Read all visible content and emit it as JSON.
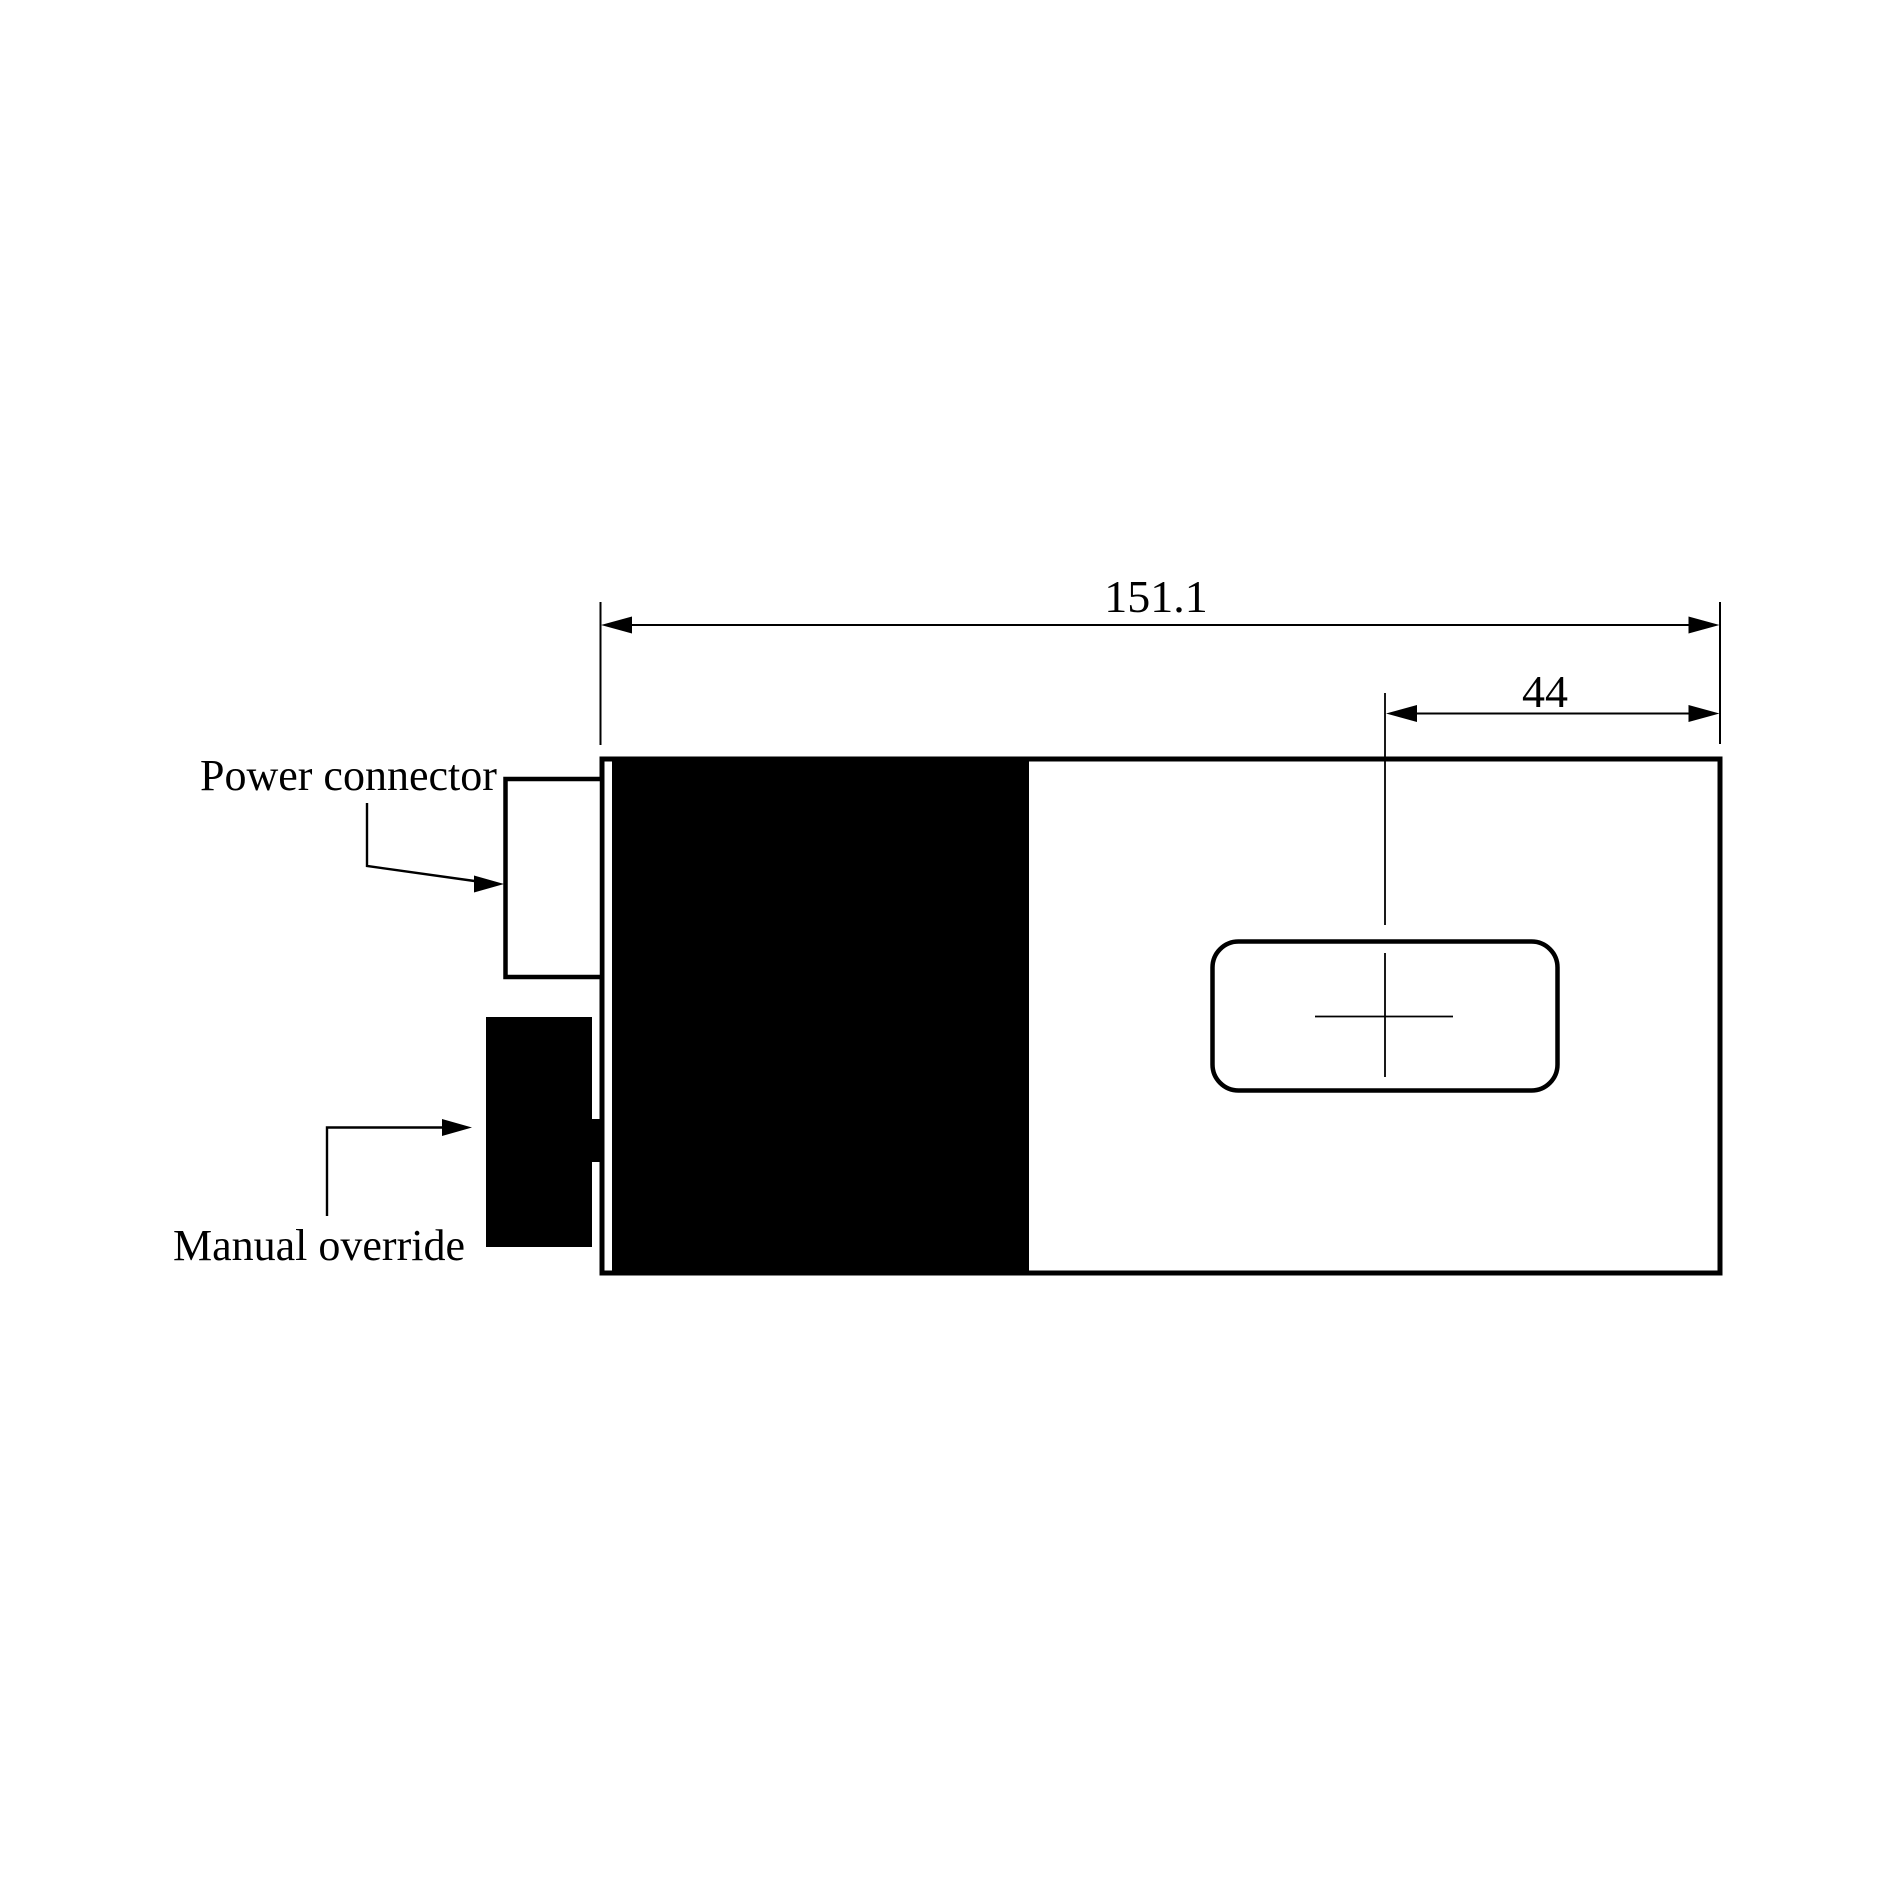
{
  "diagram": {
    "part_labels": {
      "power_connector": "Power connector",
      "manual_override": "Manual override"
    },
    "dimensions": {
      "overall_length": "151.1",
      "slot_offset": "44"
    },
    "colors": {
      "ink": "#000000",
      "paper": "#ffffff"
    }
  }
}
